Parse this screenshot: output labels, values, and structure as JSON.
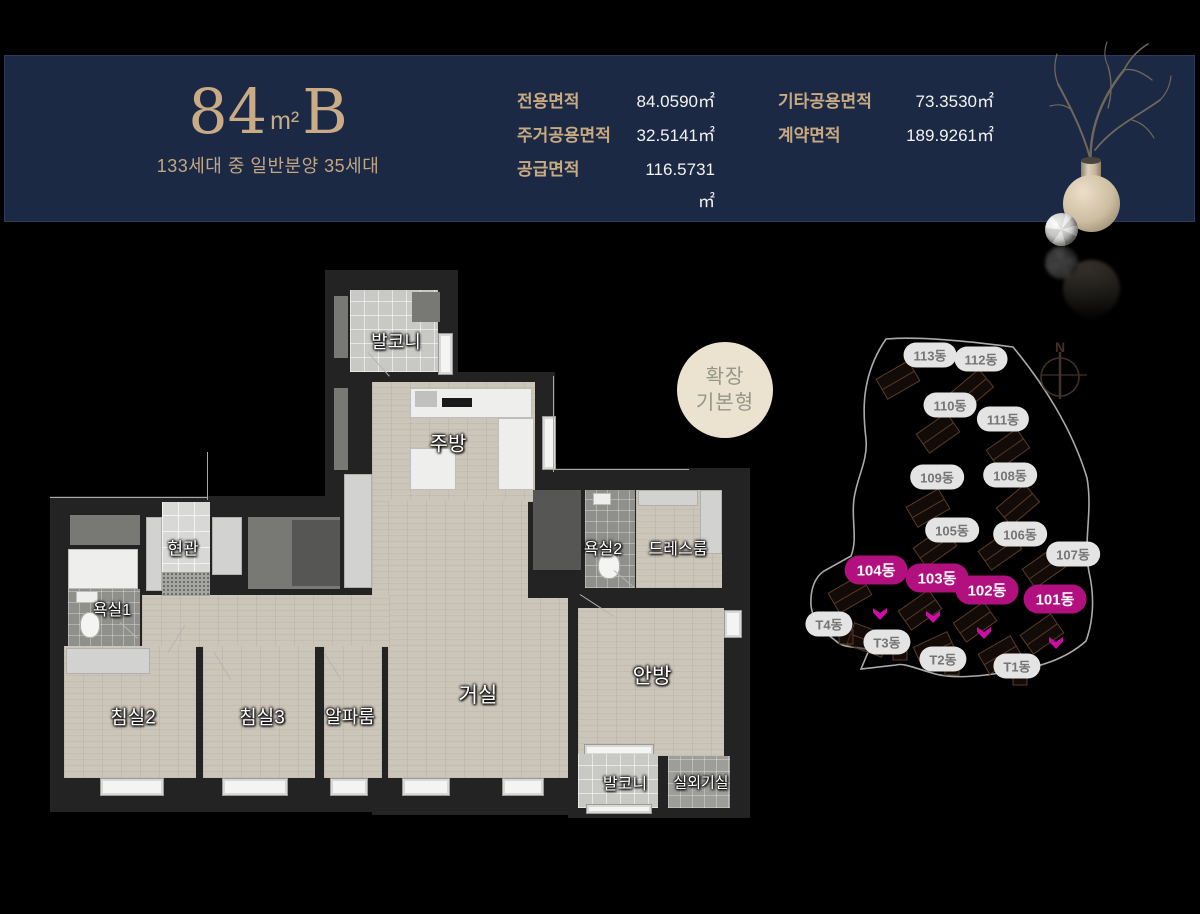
{
  "colors": {
    "background": "#000000",
    "band_navy": "#1c2944",
    "gold": "#c9ac86",
    "magenta_pill": "#b1107e",
    "marker_magenta": "#cf0da4",
    "pill_gray_bg": "#e4e4e4",
    "pill_gray_text": "#757575",
    "badge_bg": "#ebe2d0"
  },
  "header": {
    "title_number": "84",
    "title_unit": "m²",
    "title_type": "B",
    "subtitle": "133세대 중 일반분양 35세대",
    "areas_left": [
      {
        "label": "전용면적",
        "value": "84.0590㎡"
      },
      {
        "label": "주거공용면적",
        "value": "32.5141㎡"
      },
      {
        "label": "공급면적",
        "value": "116.5731㎡"
      }
    ],
    "areas_right": [
      {
        "label": "기타공용면적",
        "value": "73.3530㎡"
      },
      {
        "label": "계약면적",
        "value": "189.9261㎡"
      }
    ]
  },
  "badge": {
    "lines": [
      "확장",
      "기본형"
    ]
  },
  "floorplan": {
    "room_labels": [
      {
        "label": "발코니",
        "x": 396,
        "y": 341,
        "s": 18
      },
      {
        "label": "주방",
        "x": 448,
        "y": 442,
        "s": 20
      },
      {
        "label": "현관",
        "x": 183,
        "y": 547,
        "s": 17
      },
      {
        "label": "욕실1",
        "x": 112,
        "y": 608,
        "s": 16
      },
      {
        "label": "욕실2",
        "x": 603,
        "y": 547,
        "s": 16
      },
      {
        "label": "드레스룸",
        "x": 678,
        "y": 547,
        "s": 16
      },
      {
        "label": "침실2",
        "x": 133,
        "y": 716,
        "s": 19
      },
      {
        "label": "침실3",
        "x": 262,
        "y": 716,
        "s": 19
      },
      {
        "label": "알파룸",
        "x": 350,
        "y": 716,
        "s": 18
      },
      {
        "label": "거실",
        "x": 478,
        "y": 694,
        "s": 21
      },
      {
        "label": "안방",
        "x": 652,
        "y": 675,
        "s": 21
      },
      {
        "label": "발코니",
        "x": 625,
        "y": 782,
        "s": 16
      },
      {
        "label": "실외기실",
        "x": 701,
        "y": 782,
        "s": 15
      }
    ]
  },
  "siteplan": {
    "compass_label": "N",
    "pills": [
      {
        "label": "113동",
        "x": 930,
        "y": 355,
        "hl": false
      },
      {
        "label": "112동",
        "x": 981,
        "y": 359,
        "hl": false
      },
      {
        "label": "110동",
        "x": 950,
        "y": 405,
        "hl": false
      },
      {
        "label": "111동",
        "x": 1003,
        "y": 419,
        "hl": false
      },
      {
        "label": "109동",
        "x": 937,
        "y": 477,
        "hl": false
      },
      {
        "label": "108동",
        "x": 1010,
        "y": 475,
        "hl": false
      },
      {
        "label": "105동",
        "x": 952,
        "y": 530,
        "hl": false
      },
      {
        "label": "106동",
        "x": 1020,
        "y": 534,
        "hl": false
      },
      {
        "label": "107동",
        "x": 1073,
        "y": 554,
        "hl": false
      },
      {
        "label": "104동",
        "x": 876,
        "y": 570,
        "hl": true
      },
      {
        "label": "103동",
        "x": 937,
        "y": 578,
        "hl": true
      },
      {
        "label": "102동",
        "x": 987,
        "y": 590,
        "hl": true
      },
      {
        "label": "101동",
        "x": 1055,
        "y": 599,
        "hl": true
      },
      {
        "label": "T4동",
        "x": 829,
        "y": 624,
        "hl": false
      },
      {
        "label": "T3동",
        "x": 887,
        "y": 642,
        "hl": false
      },
      {
        "label": "T2동",
        "x": 943,
        "y": 659,
        "hl": false
      },
      {
        "label": "T1동",
        "x": 1017,
        "y": 666,
        "hl": false
      }
    ],
    "markers": [
      {
        "x": 880,
        "y": 614
      },
      {
        "x": 933,
        "y": 617
      },
      {
        "x": 984,
        "y": 633
      },
      {
        "x": 1056,
        "y": 643
      }
    ],
    "footprints": [
      {
        "x": 898,
        "y": 380,
        "r": -30
      },
      {
        "x": 972,
        "y": 390,
        "r": -40
      },
      {
        "x": 938,
        "y": 433,
        "r": -35
      },
      {
        "x": 1008,
        "y": 449,
        "r": -35
      },
      {
        "x": 928,
        "y": 508,
        "r": -30
      },
      {
        "x": 1018,
        "y": 505,
        "r": -40
      },
      {
        "x": 935,
        "y": 547,
        "r": -35
      },
      {
        "x": 1000,
        "y": 550,
        "r": -35
      },
      {
        "x": 1044,
        "y": 568,
        "r": -35
      },
      {
        "x": 850,
        "y": 594,
        "r": -30
      },
      {
        "x": 920,
        "y": 610,
        "r": -35
      },
      {
        "x": 975,
        "y": 622,
        "r": -35
      },
      {
        "x": 1042,
        "y": 634,
        "r": -35
      },
      {
        "x": 868,
        "y": 640,
        "r": 20
      },
      {
        "x": 935,
        "y": 650,
        "r": -25
      },
      {
        "x": 1000,
        "y": 655,
        "r": -30
      },
      {
        "x": 846,
        "y": 637,
        "r": 0,
        "small": true
      },
      {
        "x": 900,
        "y": 653,
        "r": 0,
        "small": true
      },
      {
        "x": 952,
        "y": 668,
        "r": 0,
        "small": true
      },
      {
        "x": 1020,
        "y": 678,
        "r": 0,
        "small": true
      }
    ]
  }
}
